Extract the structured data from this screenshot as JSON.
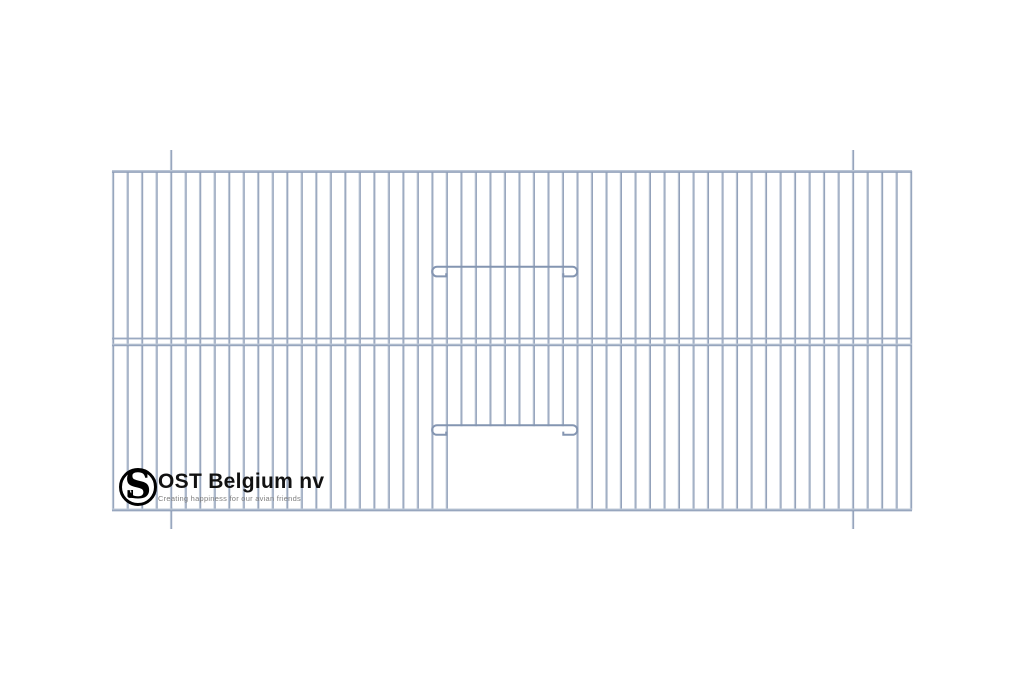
{
  "canvas": {
    "width": 1024,
    "height": 683,
    "background": "#ffffff"
  },
  "drawing": {
    "type": "bird-cage-front-panel",
    "wire_color": "#8495b1",
    "wire_mid": "#a9b6c9",
    "wire_light": "#cfd8e4",
    "frame": {
      "x_left": 113,
      "x_right": 911,
      "y_top": 171,
      "y_bottom": 508.5
    },
    "bars": {
      "count": 56,
      "width": 2.3
    },
    "mid_rail": {
      "y_upper": 337.6,
      "y_lower": 343.6,
      "upper_thickness": 1.8,
      "lower_thickness": 2.6
    },
    "rail_thickness": 2.8,
    "hanger_bars": {
      "indices": [
        4,
        51
      ],
      "extend_top_to": 150,
      "extend_bottom_to": 529
    },
    "door": {
      "open_left_bar": 23,
      "open_right_bar": 32,
      "stopped_bar_first": 24,
      "stopped_bar_last": 31
    },
    "wires": {
      "upper_y": 266.8,
      "door_y": 425.2,
      "loop_radius": 4.8,
      "left_tip_bar": 22,
      "right_tip_bar": 32,
      "stub_len": 14,
      "tick_len": 3.2
    }
  },
  "logo": {
    "monogram": "S",
    "monogram_small": "d",
    "company": "OST Belgium nv",
    "tagline": "Creating happiness for our avian friends"
  }
}
